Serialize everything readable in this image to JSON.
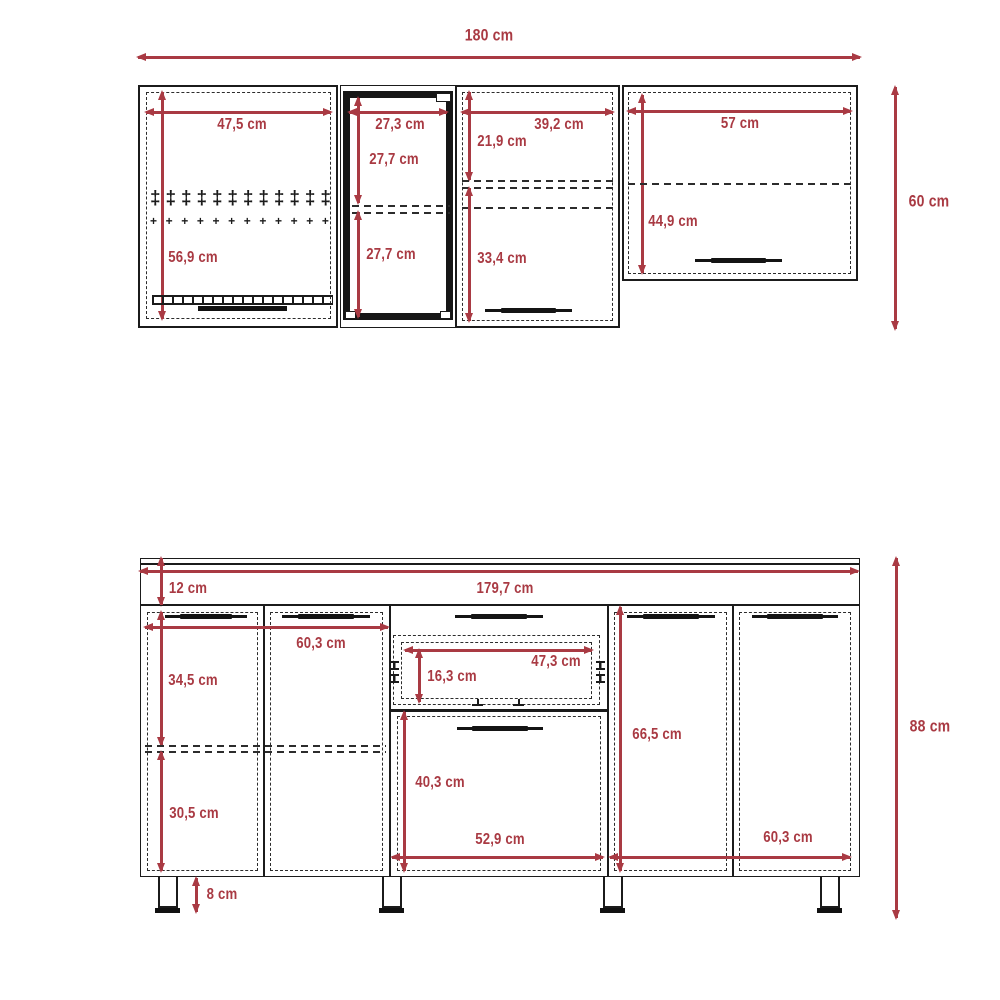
{
  "colors": {
    "dimension_red": "#a93a43",
    "line_black": "#1b1b1b"
  },
  "upper": {
    "total_width": "180 cm",
    "total_height": "60 cm",
    "cab1": {
      "width": "47,5 cm",
      "height": "56,9 cm"
    },
    "cab2": {
      "width": "27,3 cm",
      "top_height": "27,7 cm",
      "bottom_height": "27,7 cm"
    },
    "cab3": {
      "width": "39,2 cm",
      "top_height": "21,9 cm",
      "bottom_height": "33,4 cm"
    },
    "cab4": {
      "width": "57 cm",
      "height": "44,9 cm"
    }
  },
  "lower": {
    "counter_thickness": "12 cm",
    "total_width": "179,7 cm",
    "total_height": "88 cm",
    "leg_height": "8 cm",
    "left": {
      "width": "60,3 cm",
      "top_height": "34,5 cm",
      "bottom_height": "30,5 cm"
    },
    "center": {
      "drawer_width": "47,3 cm",
      "drawer_height": "16,3 cm",
      "door_height": "40,3 cm",
      "width": "52,9 cm"
    },
    "right": {
      "height": "66,5 cm",
      "width": "60,3 cm"
    }
  },
  "decor": {
    "rack_pins": {
      "glyph": "‡",
      "count": 12
    },
    "rack_crosses": {
      "glyph": "+",
      "count": 12
    }
  }
}
